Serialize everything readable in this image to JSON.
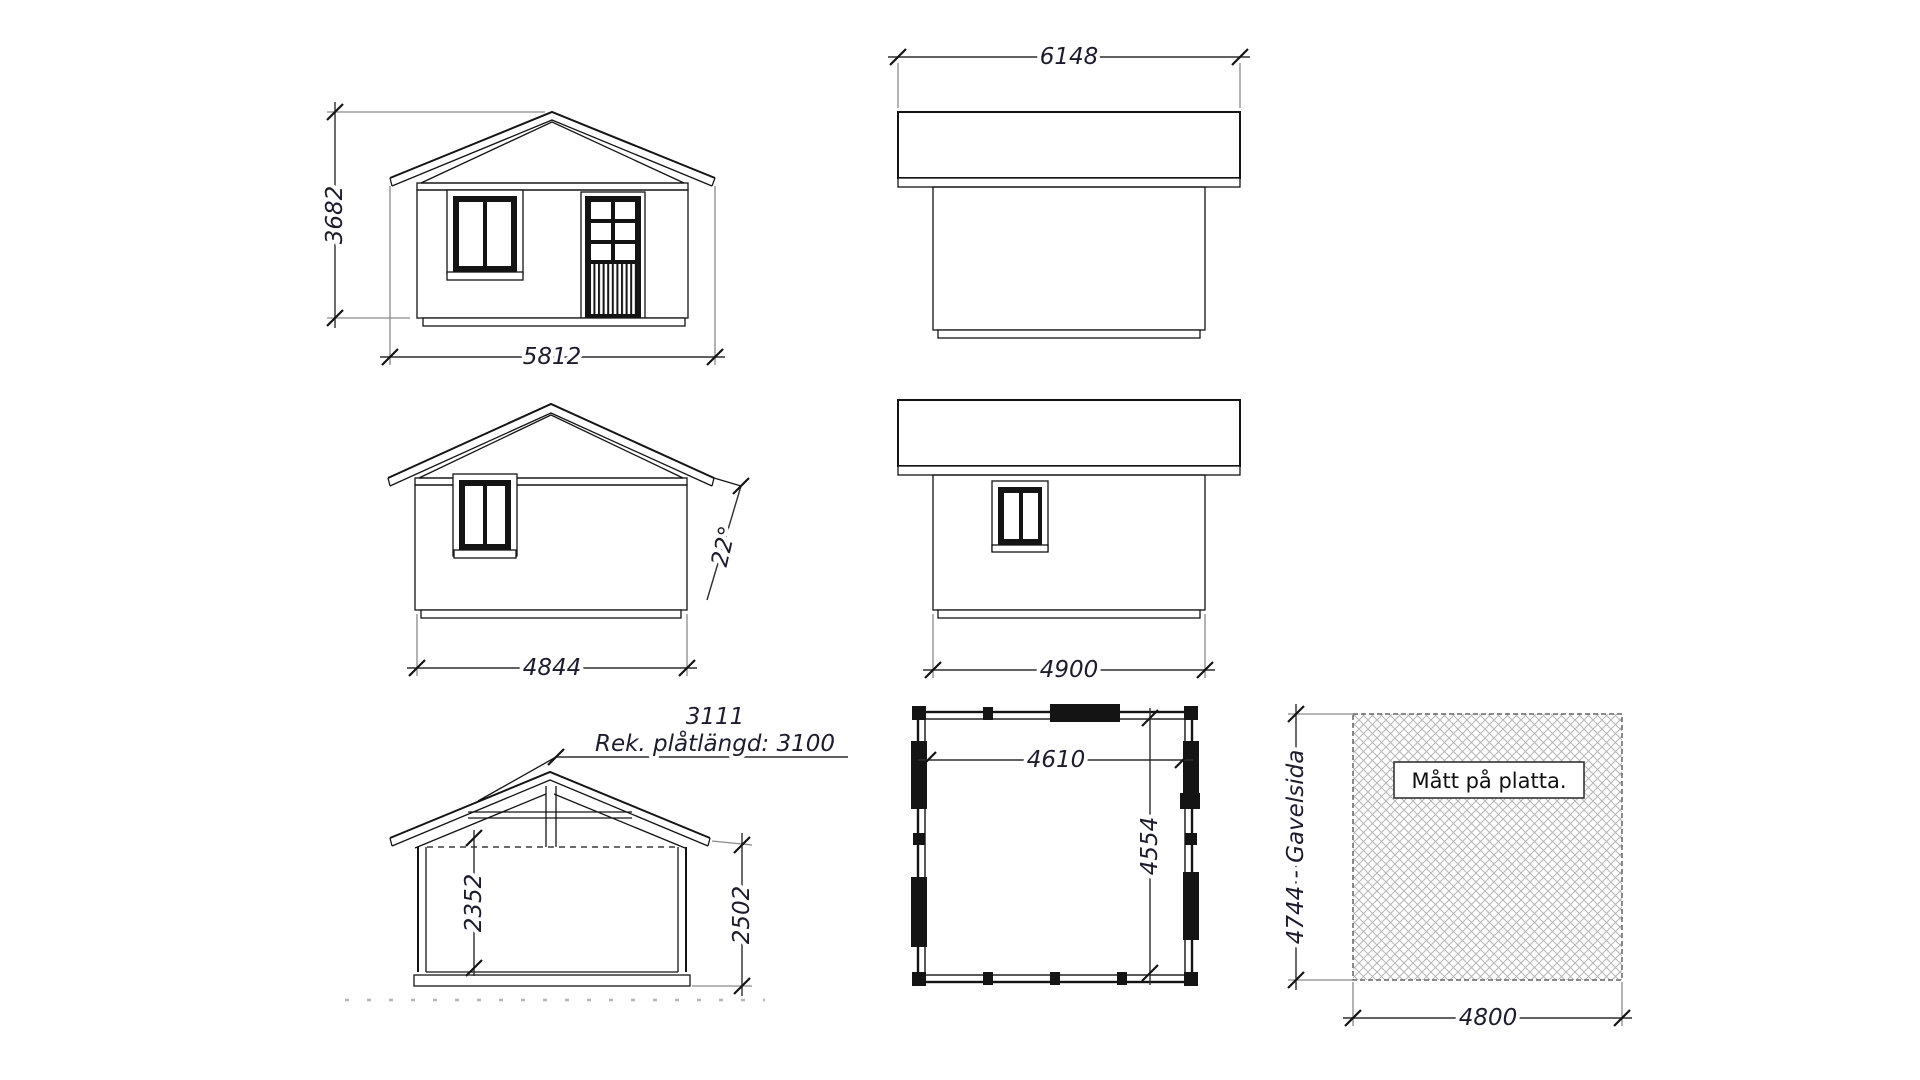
{
  "drawing": {
    "front_elevation": {
      "height": "3682",
      "width": "5812"
    },
    "roof_side_top": {
      "length": "6148"
    },
    "rear_elevation": {
      "width": "4844",
      "roof_angle": "22°"
    },
    "side_elevation": {
      "length": "4900"
    },
    "section": {
      "roof_slope_length": "3111",
      "sheet_note": "Rek. plåtlängd: 3100",
      "inner_height": "2352",
      "wall_height": "2502"
    },
    "floor_plan": {
      "inner_width": "4610",
      "inner_depth": "4554"
    },
    "foundation_plan": {
      "title": "Mått på platta.",
      "gable_side": "4744 - Gavelsida",
      "width": "4800"
    }
  },
  "colors": {
    "background": "#ffffff",
    "line": "#141414",
    "dimension_text": "#1c1c2e",
    "extension_line": "#8a8a8a",
    "hatch": "#b6b6b6"
  }
}
